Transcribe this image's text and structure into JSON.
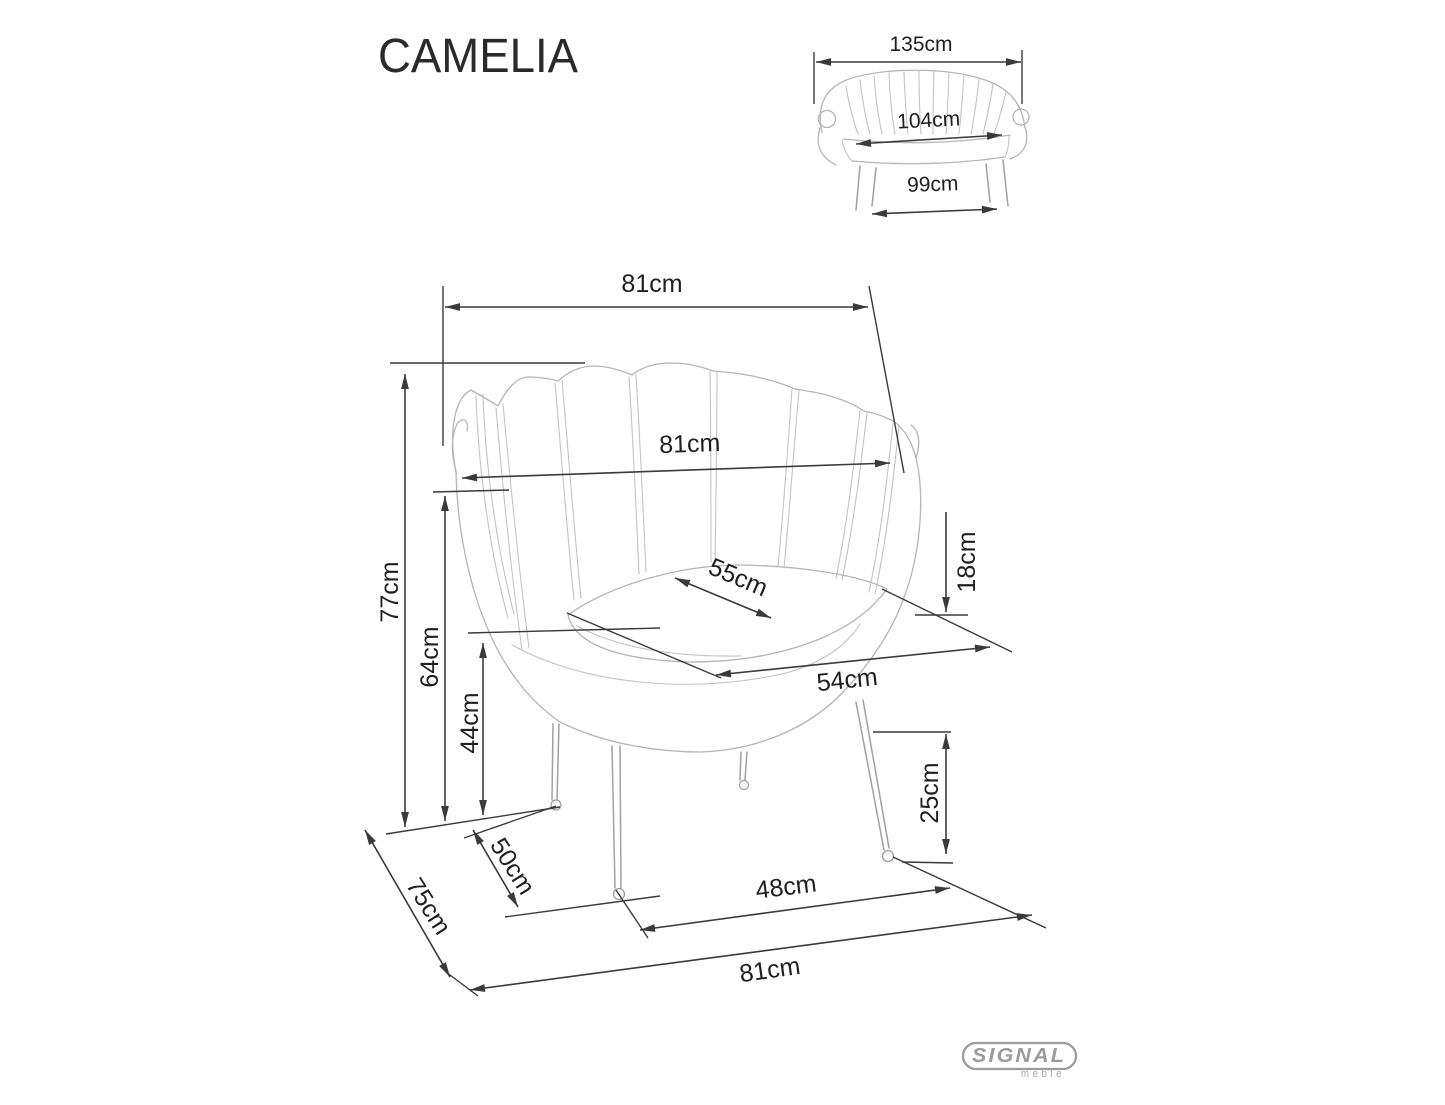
{
  "title": "CAMELIA",
  "logo": {
    "brand": "SIGNAL",
    "sub": "meble"
  },
  "sofa_view": {
    "overall_width": "135cm",
    "seat_width": "104cm",
    "leg_span": "99cm"
  },
  "chair_view": {
    "overall_width": "81cm",
    "backrest_width": "81cm",
    "total_height": "77cm",
    "armrest_height": "64cm",
    "seat_height": "44cm",
    "seat_width": "55cm",
    "seat_depth": "54cm",
    "cushion_thickness": "18cm",
    "leg_height": "25cm",
    "overall_depth": "75cm",
    "leg_depth_span": "50cm",
    "front_leg_span": "48cm",
    "base_width": "81cm"
  },
  "colors": {
    "dimension_lines": "#3a3a3a",
    "label_text": "#1f1f1f",
    "artwork_lines": "#b5b5b5",
    "logo_gray": "#9b9b9b",
    "background": "#ffffff"
  }
}
